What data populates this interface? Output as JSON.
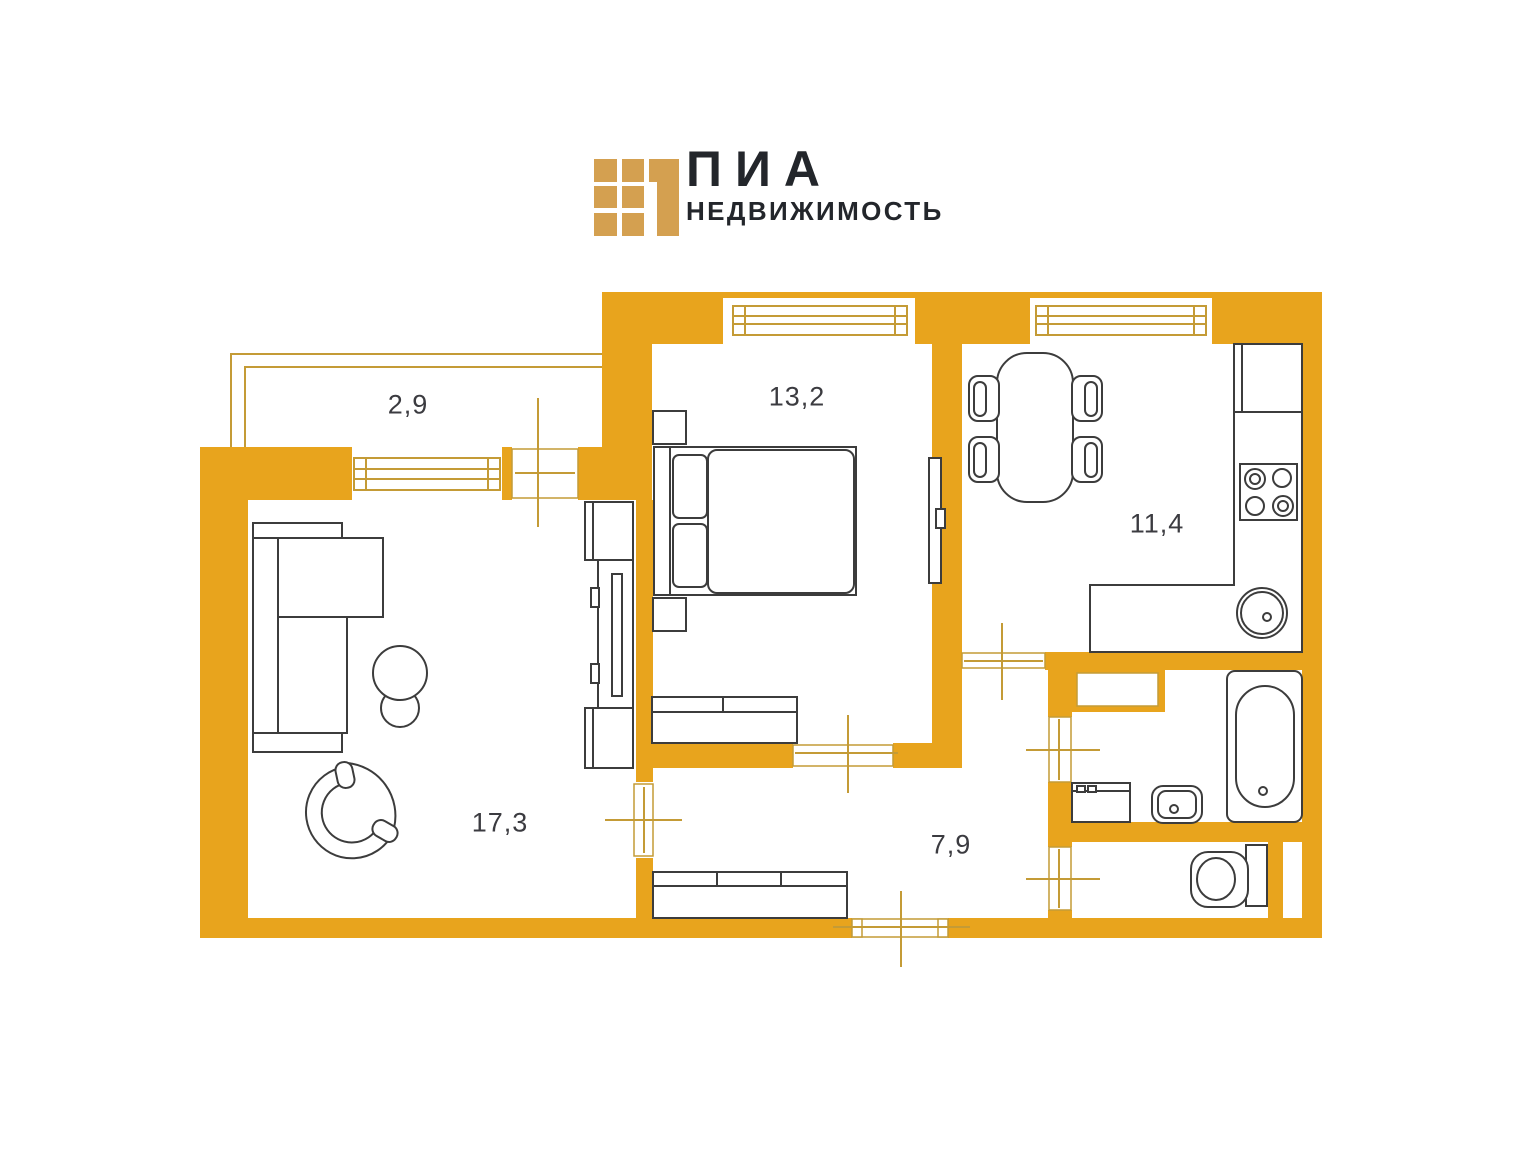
{
  "brand": {
    "title": "ПИА",
    "subtitle": "НЕДВИЖИМОСТЬ"
  },
  "icons": [
    {
      "name": "logo-mark",
      "shape": "grid-of-gold-squares-with-corner-bracket"
    }
  ],
  "colors": {
    "wall": "#E8A41D",
    "accent_line": "#C49B36",
    "furniture_line": "#3C3C3C",
    "label_text": "#3B3B40",
    "logo_gold": "#D4A050",
    "logo_text": "#23262B",
    "background": "#FFFFFF"
  },
  "rooms": [
    {
      "name": "balcony",
      "area": "2,9"
    },
    {
      "name": "bedroom",
      "area": "13,2"
    },
    {
      "name": "kitchen",
      "area": "11,4"
    },
    {
      "name": "living-room",
      "area": "17,3"
    },
    {
      "name": "hallway",
      "area": "7,9"
    }
  ]
}
